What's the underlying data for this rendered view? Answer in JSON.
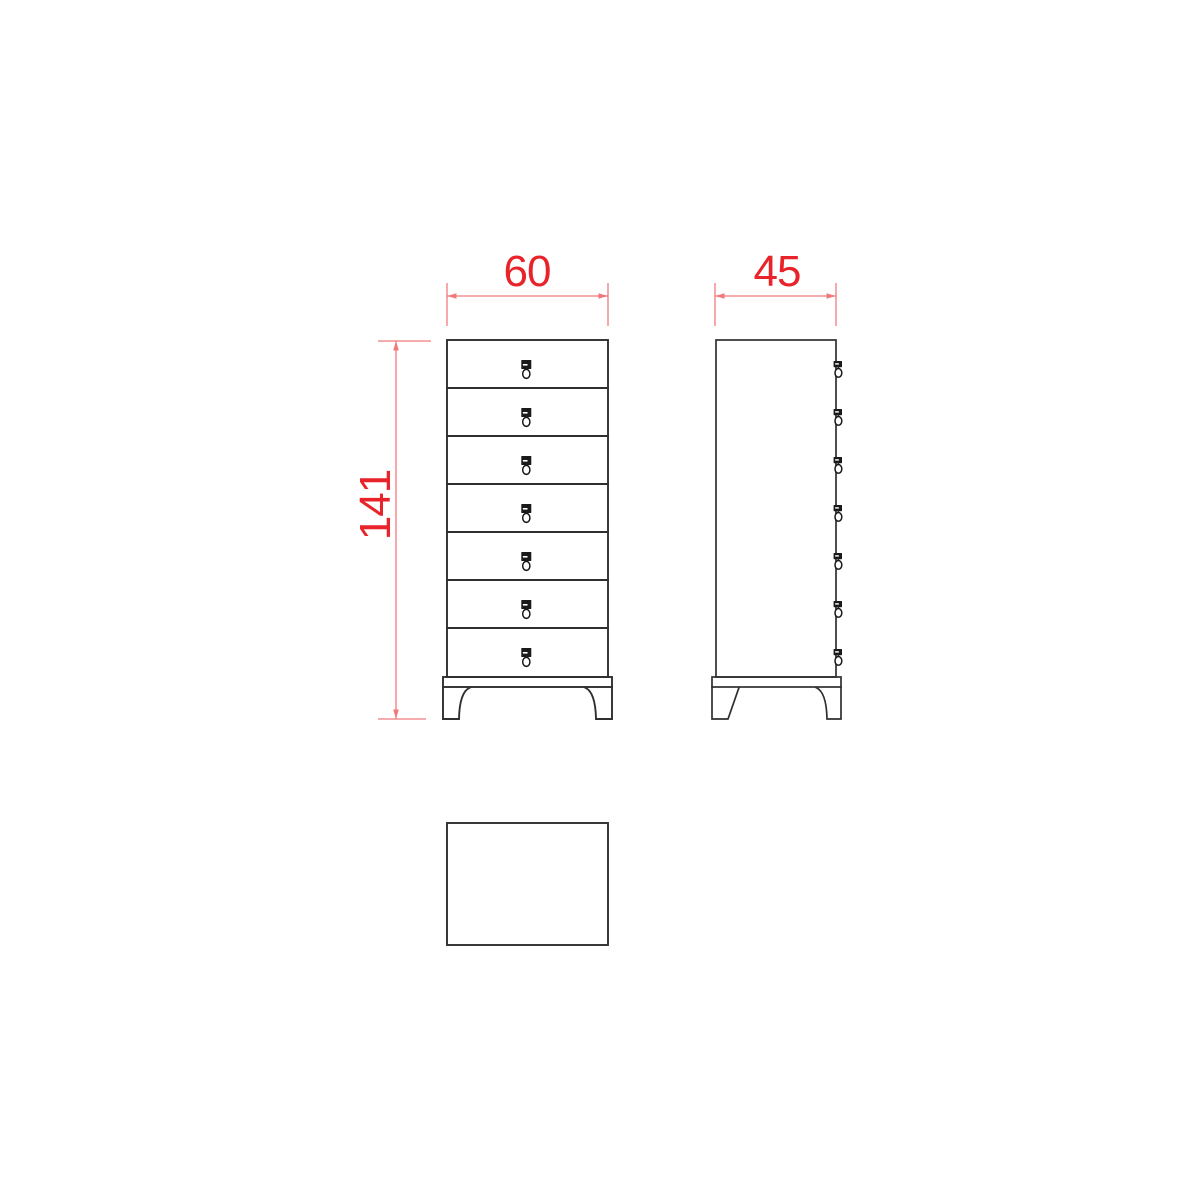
{
  "drawing": {
    "dimensions": {
      "width": {
        "value": "60"
      },
      "depth": {
        "value": "45"
      },
      "height": {
        "value": "141"
      }
    },
    "views": {
      "front": {
        "drawer_count": 7,
        "handle_count": 7
      },
      "side": {
        "handle_count": 7
      }
    },
    "colors": {
      "dimension_text_red": "#e8232a",
      "dimension_line_red": "#f0797c",
      "line_black": "#2f2f2f",
      "handle_black": "#1a1a1a",
      "background": "#ffffff"
    }
  }
}
